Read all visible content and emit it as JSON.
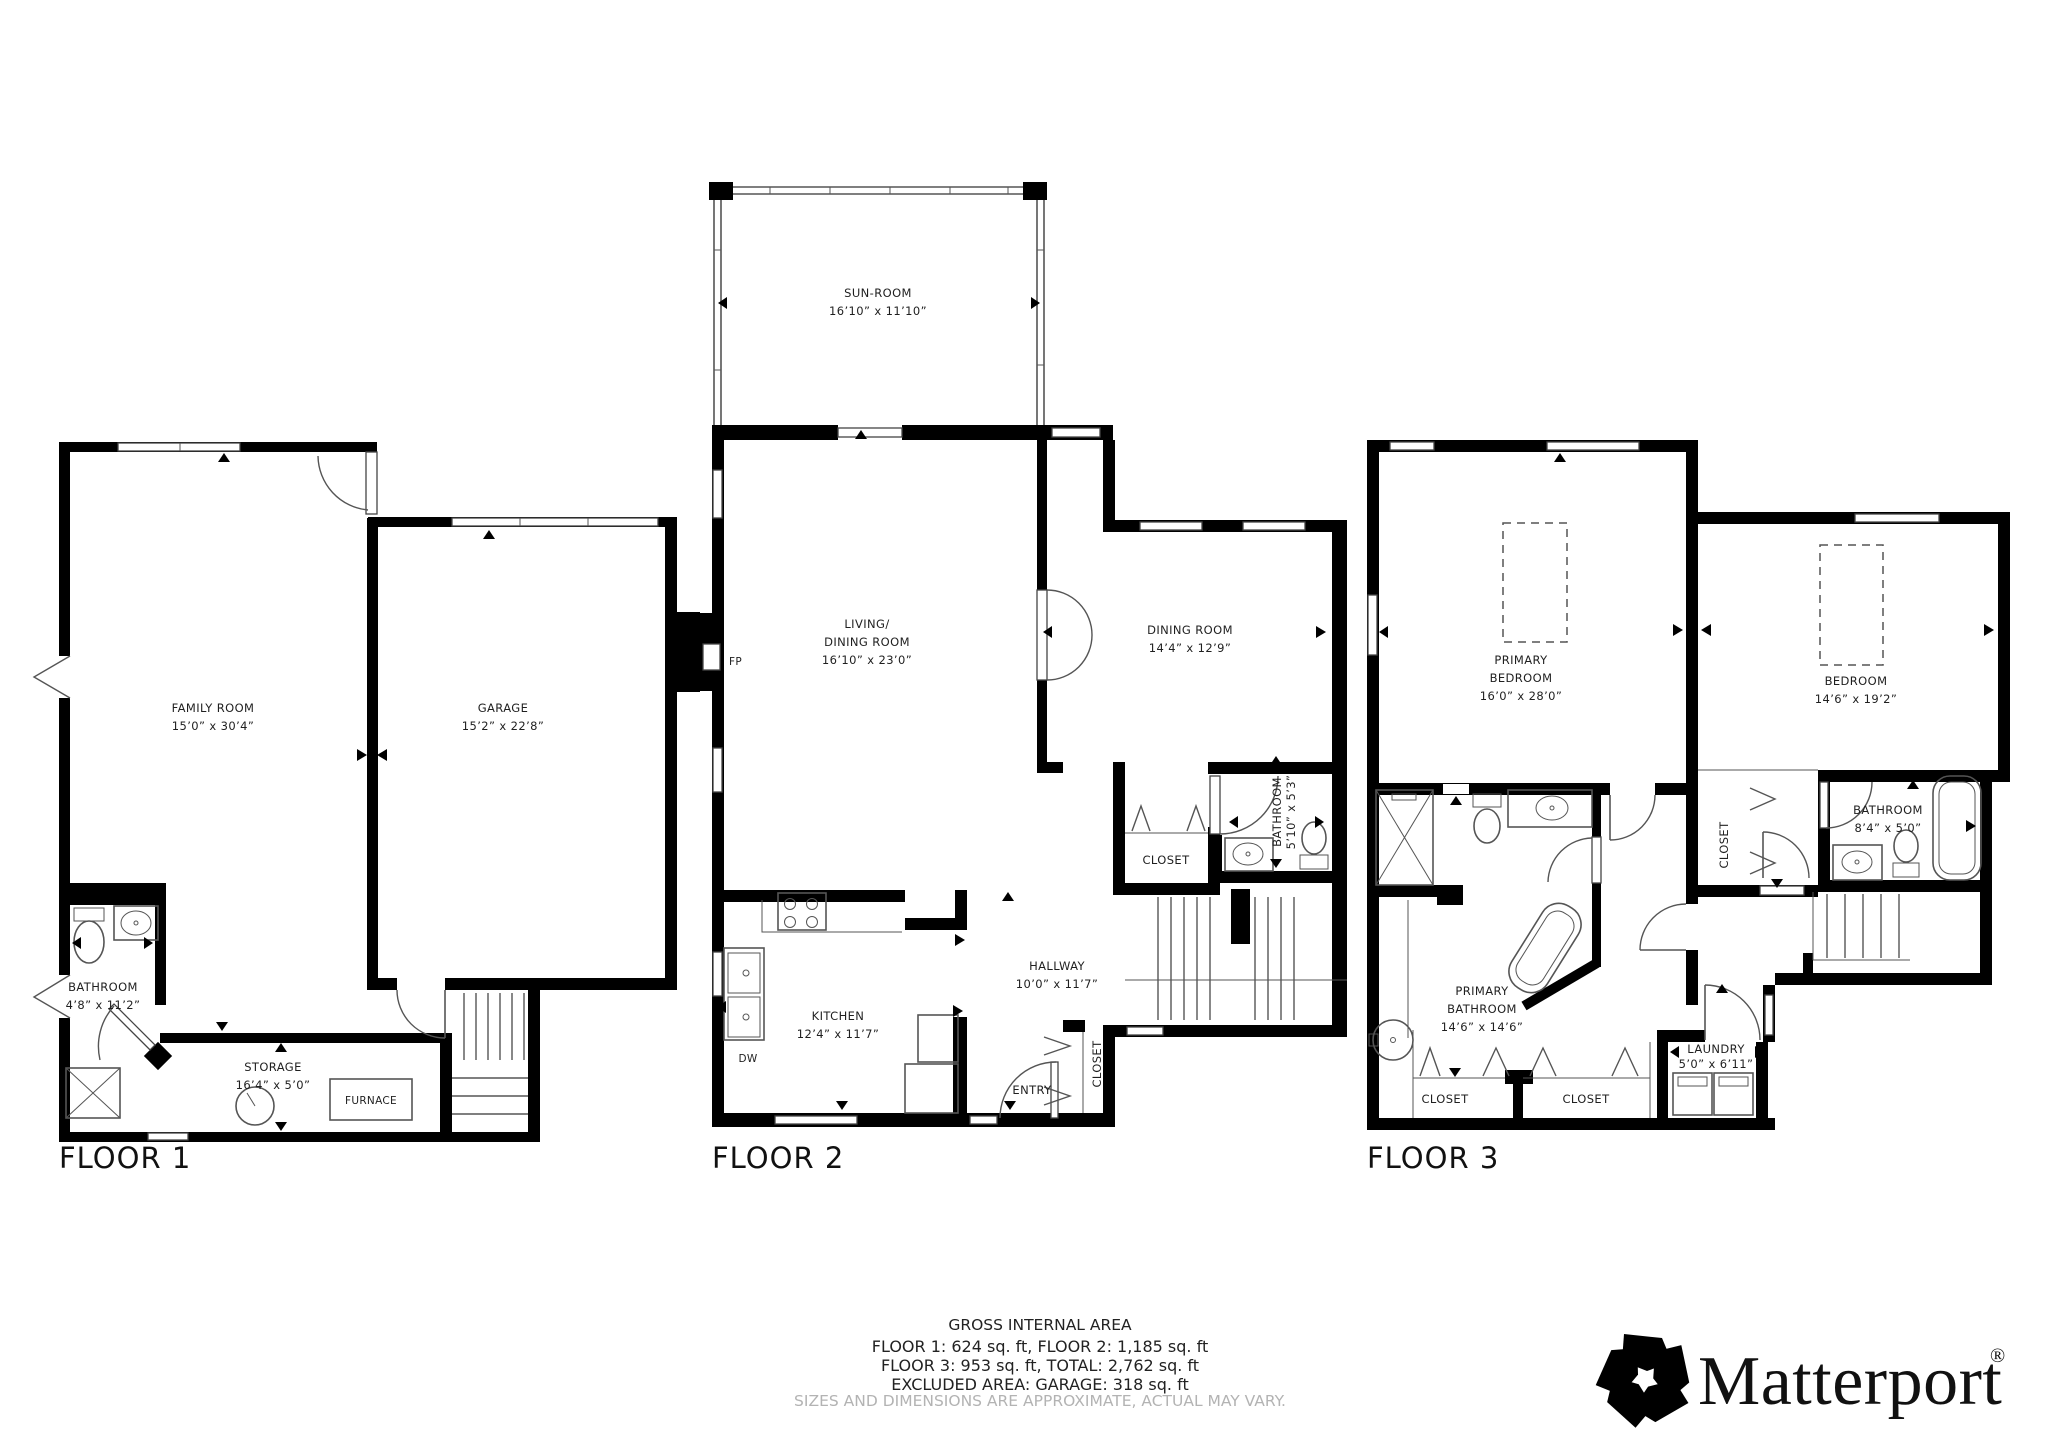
{
  "floors": [
    {
      "label": "FLOOR 1",
      "rooms": {
        "family": {
          "name": "FAMILY ROOM",
          "dims": "15’0” x 30’4”"
        },
        "garage": {
          "name": "GARAGE",
          "dims": "15’2” x 22’8”"
        },
        "bathroom": {
          "name": "BATHROOM",
          "dims": "4’8” x 11’2”"
        },
        "storage": {
          "name": "STORAGE",
          "dims": "16’4” x 5’0”"
        }
      },
      "labels": {
        "furnace": "FURNACE"
      }
    },
    {
      "label": "FLOOR 2",
      "rooms": {
        "sunroom": {
          "name": "SUN-ROOM",
          "dims": "16’10” x 11’10”"
        },
        "living": {
          "line1": "LIVING/",
          "line2": "DINING ROOM",
          "dims": "16’10” x 23’0”"
        },
        "dining": {
          "name": "DINING ROOM",
          "dims": "14’4” x 12’9”"
        },
        "kitchen": {
          "name": "KITCHEN",
          "dims": "12’4” x 11’7”"
        },
        "hallway": {
          "name": "HALLWAY",
          "dims": "10’0” x 11’7”"
        },
        "bathroom": {
          "name": "BATHROOM",
          "dims": "5’10” x 5’3”"
        }
      },
      "labels": {
        "closet": "CLOSET",
        "entry": "ENTRY",
        "entry_closet": "CLOSET",
        "fp": "FP",
        "dw": "DW"
      }
    },
    {
      "label": "FLOOR 3",
      "rooms": {
        "primary_bedroom": {
          "line1": "PRIMARY",
          "line2": "BEDROOM",
          "dims": "16’0” x 28’0”"
        },
        "bedroom": {
          "name": "BEDROOM",
          "dims": "14’6” x 19’2”"
        },
        "primary_bathroom": {
          "line1": "PRIMARY",
          "line2": "BATHROOM",
          "dims": "14’6” x 14’6”"
        },
        "bathroom": {
          "name": "BATHROOM",
          "dims": "8’4” x 5’0”"
        },
        "laundry": {
          "name": "LAUNDRY",
          "dims": "5’0” x 6’11”"
        }
      },
      "labels": {
        "closet1": "CLOSET",
        "closet2": "CLOSET",
        "walkin_closet": "CLOSET"
      }
    }
  ],
  "footer": {
    "title": "GROSS INTERNAL AREA",
    "line1": "FLOOR 1: 624 sq. ft, FLOOR 2: 1,185 sq. ft",
    "line2": "FLOOR 3: 953 sq. ft, TOTAL: 2,762 sq. ft",
    "line3": "EXCLUDED AREA: GARAGE: 318 sq. ft",
    "disclaimer": "SIZES AND DIMENSIONS ARE APPROXIMATE, ACTUAL MAY VARY."
  },
  "brand": {
    "wordmark": "Matterport",
    "registered": "®"
  }
}
